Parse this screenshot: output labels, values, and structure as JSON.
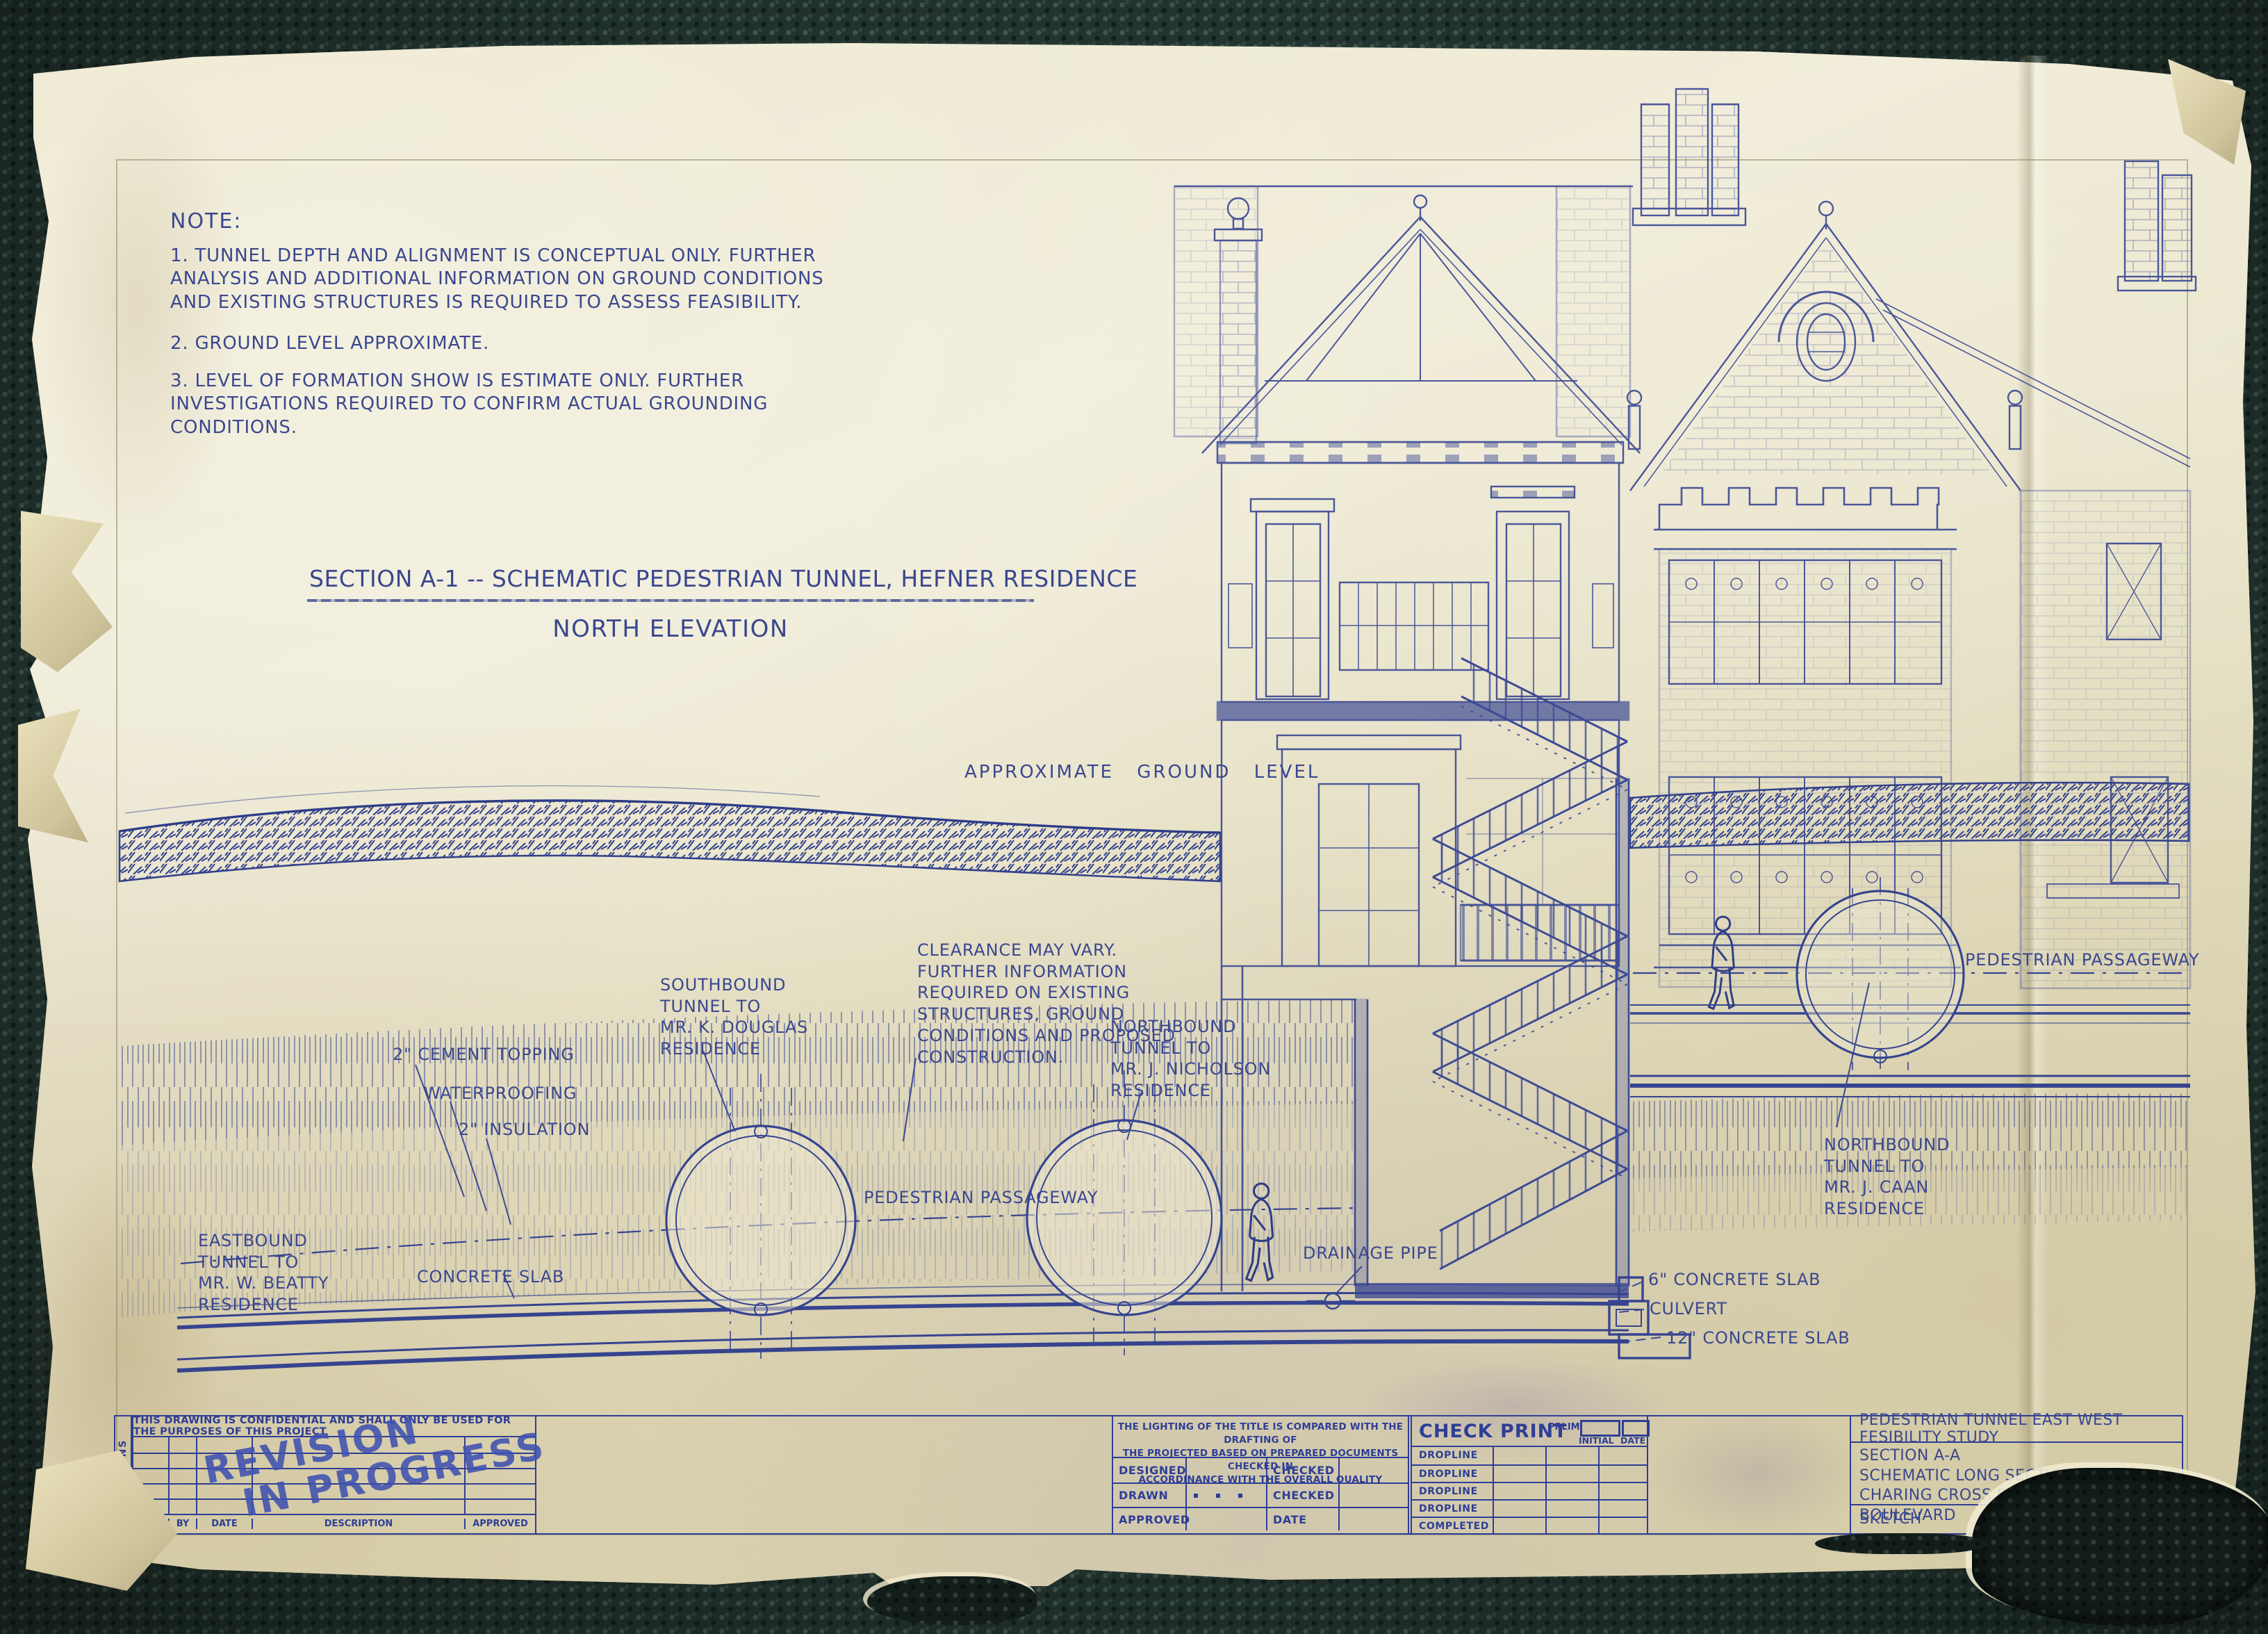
{
  "colors": {
    "ink": "#3a478f",
    "paper": "#ebe6cb",
    "carpet": "#2b3e38",
    "stamp": "#3f51b0"
  },
  "notes": {
    "heading": "NOTE:",
    "item1": "1. TUNNEL DEPTH AND ALIGNMENT IS CONCEPTUAL ONLY. FURTHER\nANALYSIS AND ADDITIONAL INFORMATION ON GROUND CONDITIONS\nAND EXISTING STRUCTURES IS REQUIRED TO ASSESS FEASIBILITY.",
    "item2": "2. GROUND LEVEL APPROXIMATE.",
    "item3": "3. LEVEL OF FORMATION SHOW IS ESTIMATE ONLY. FURTHER\nINVESTIGATIONS REQUIRED TO CONFIRM ACTUAL GROUNDING\nCONDITIONS."
  },
  "title": {
    "main": "SECTION A-1 -- SCHEMATIC PEDESTRIAN TUNNEL, HEFNER RESIDENCE",
    "sub": "NORTH ELEVATION"
  },
  "labels": {
    "ground_level": "APPROXIMATE GROUND LEVEL",
    "cement_topping": "2\" CEMENT TOPPING",
    "waterproofing": "WATERPROOFING",
    "insulation": "2\" INSULATION",
    "southbound_tunnel": "SOUTHBOUND\nTUNNEL TO\nMR. K. DOUGLAS\nRESIDENCE",
    "clearance_note": "CLEARANCE MAY VARY.\nFURTHER INFORMATION\nREQUIRED ON EXISTING\nSTRUCTURES, GROUND\nCONDITIONS AND PROPOSED\nCONSTRUCTION.",
    "northbound_tunnel_nicholson": "NORTHBOUND\nTUNNEL TO\nMR. J. NICHOLSON\nRESIDENCE",
    "eastbound_tunnel": "EASTBOUND\nTUNNEL TO\nMR. W. BEATTY\nRESIDENCE",
    "concrete_slab": "CONCRETE SLAB",
    "pedestrian_passageway_left": "PEDESTRIAN PASSAGEWAY",
    "drainage_pipe": "DRAINAGE PIPE",
    "concrete_slab_6": "6\" CONCRETE SLAB",
    "culvert": "CULVERT",
    "concrete_slab_12": "12\" CONCRETE SLAB",
    "pedestrian_passageway_right": "PEDESTRIAN PASSAGEWAY",
    "northbound_tunnel_caan": "NORTHBOUND\nTUNNEL TO\nMR. J. CAAN\nRESIDENCE"
  },
  "title_block": {
    "confidential": "THIS DRAWING IS CONFIDENTIAL AND SHALL ONLY BE USED FOR THE PURPOSES OF THIS PROJECT",
    "revisions_label": "REVISIONS",
    "columns": {
      "src": "SRC",
      "by": "BY",
      "date": "DATE",
      "description": "DESCRIPTION",
      "approved": "APPROVED"
    },
    "stamp": {
      "line1": "REVISION",
      "line2": "IN PROGRESS"
    },
    "quality_note": "THE LIGHTING OF THE TITLE IS COMPARED WITH THE DRAFTING OF\nTHE PROJECTED BASED ON PREPARED DOCUMENTS CHECKED IN\nACCORDINANCE WITH THE OVERALL QUALITY",
    "sign_rows": {
      "designed": "DESIGNED",
      "checked1": "CHECKED",
      "drawn": "DRAWN",
      "checked2": "CHECKED",
      "approved": "APPROVED",
      "date": "DATE"
    },
    "check_print": {
      "heading": "CHECK PRINT",
      "prlim": "PRLIM",
      "initial": "INITIAL",
      "date": "DATE",
      "rows": [
        "DROPLINE",
        "DROPLINE",
        "DROPLINE",
        "DROPLINE",
        "COMPLETED"
      ]
    },
    "project": {
      "study": "PEDESTRIAN TUNNEL EAST WEST FESIBILITY STUDY",
      "description": "SECTION A-A\nSCHEMATIC LONG SECTION\nCHARING CROSS ROAD TO SUNSET BOULEVARD",
      "type": "SKETCH",
      "number": "600273"
    }
  }
}
